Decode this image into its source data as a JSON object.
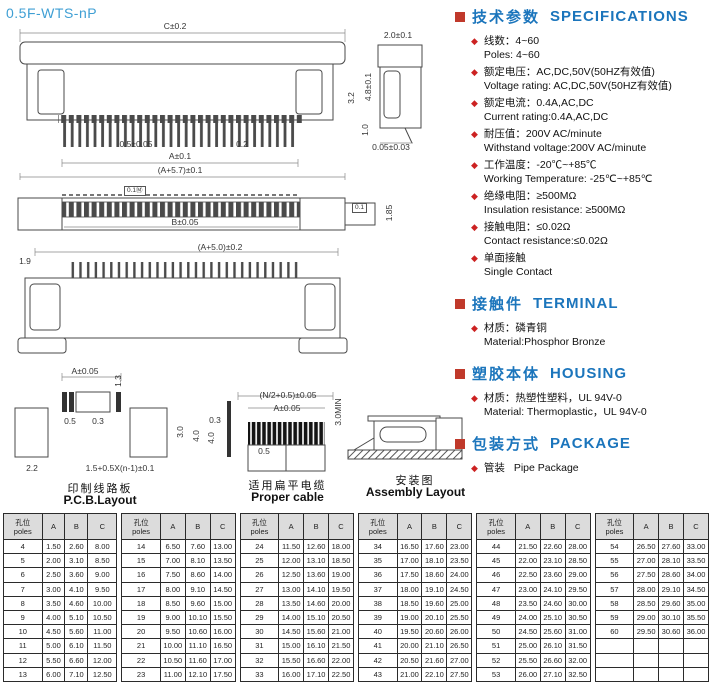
{
  "page": {
    "title": "0.5F-WTS-nP"
  },
  "colors": {
    "accent_blue": "#1b75bc",
    "title_blue": "#3f9fd4",
    "bullet_red": "#c0392b",
    "diamond_red": "#cc2222"
  },
  "specs": {
    "heading_cn": "技术参数",
    "heading_en": "SPECIFICATIONS",
    "items": [
      {
        "cn": "线数：4~60",
        "en": "Poles: 4~60"
      },
      {
        "cn": "额定电压：AC,DC,50V(50HZ有效值)",
        "en": "Voltage rating: AC,DC,50V(50HZ有效值)"
      },
      {
        "cn": "额定电流：0.4A,AC,DC",
        "en": "Current rating:0.4A,AC,DC"
      },
      {
        "cn": "耐压值：200V AC/minute",
        "en": "Withstand voltage:200V AC/minute"
      },
      {
        "cn": "工作温度：-20℃~+85℃",
        "en": "Working Temperature: -25℃~+85℃"
      },
      {
        "cn": "绝缘电阻：≥500MΩ",
        "en": "Insulation resistance: ≥500MΩ"
      },
      {
        "cn": "接触电阻：≤0.02Ω",
        "en": "Contact resistance:≤0.02Ω"
      },
      {
        "cn": "单面接触",
        "en": "Single Contact"
      }
    ]
  },
  "terminal": {
    "heading_cn": "接触件",
    "heading_en": "TERMINAL",
    "item_cn": "材质：磷青铜",
    "item_en": "Material:Phosphor Bronze"
  },
  "housing": {
    "heading_cn": "塑胶本体",
    "heading_en": "HOUSING",
    "item_cn": "材质：热塑性塑料，UL 94V-0",
    "item_en": "Material: Thermoplastic，UL 94V-0"
  },
  "package": {
    "heading_cn": "包装方式",
    "heading_en": "PACKAGE",
    "item_cn": "管装",
    "item_en": "Pipe Package"
  },
  "drawings": {
    "front": {
      "c": "C±0.2",
      "pitch": "0.5±0.05",
      "pin_w": "0.2",
      "a": "A±0.1",
      "total": "(A+5.7)±0.1",
      "h": "3.2"
    },
    "side": {
      "top": "2.0±0.1",
      "h": "4.8±0.1",
      "foot": "1.0",
      "bottom": "0.05±0.03"
    },
    "top_view": {
      "b": "B±0.05",
      "h": "1.85",
      "tol_left": "0.1Ⓜ",
      "tol_right": "0.1"
    },
    "bottom_view": {
      "total": "(A+5.0)±0.2",
      "edge": "1.9"
    },
    "pcb": {
      "a": "A±0.05",
      "d13": "1.3",
      "d05": "0.5",
      "d03": "0.3",
      "d30": "3.0",
      "d40": "4.0",
      "d22": "2.2",
      "formula": "1.5+0.5X(n-1)±0.1",
      "side03": "0.3",
      "side40": "4.0",
      "cap_cn": "印制线路板",
      "cap_en": "P.C.B.Layout"
    },
    "cable": {
      "n": "(N/2+0.5)±0.05",
      "a": "A±0.05",
      "min": "3.0MIN",
      "d05": "0.5",
      "cap_cn": "适用扁平电缆",
      "cap_en": "Proper cable"
    },
    "assembly": {
      "cap_cn": "安装图",
      "cap_en": "Assembly Layout"
    }
  },
  "table": {
    "header": {
      "poles_cn": "孔位",
      "poles_en": "poles",
      "a": "A",
      "b": "B",
      "c": "C"
    },
    "groups": [
      [
        [
          "4",
          "1.50",
          "2.60",
          "8.00"
        ],
        [
          "5",
          "2.00",
          "3.10",
          "8.50"
        ],
        [
          "6",
          "2.50",
          "3.60",
          "9.00"
        ],
        [
          "7",
          "3.00",
          "4.10",
          "9.50"
        ],
        [
          "8",
          "3.50",
          "4.60",
          "10.00"
        ],
        [
          "9",
          "4.00",
          "5.10",
          "10.50"
        ],
        [
          "10",
          "4.50",
          "5.60",
          "11.00"
        ],
        [
          "11",
          "5.00",
          "6.10",
          "11.50"
        ],
        [
          "12",
          "5.50",
          "6.60",
          "12.00"
        ],
        [
          "13",
          "6.00",
          "7.10",
          "12.50"
        ]
      ],
      [
        [
          "14",
          "6.50",
          "7.60",
          "13.00"
        ],
        [
          "15",
          "7.00",
          "8.10",
          "13.50"
        ],
        [
          "16",
          "7.50",
          "8.60",
          "14.00"
        ],
        [
          "17",
          "8.00",
          "9.10",
          "14.50"
        ],
        [
          "18",
          "8.50",
          "9.60",
          "15.00"
        ],
        [
          "19",
          "9.00",
          "10.10",
          "15.50"
        ],
        [
          "20",
          "9.50",
          "10.60",
          "16.00"
        ],
        [
          "21",
          "10.00",
          "11.10",
          "16.50"
        ],
        [
          "22",
          "10.50",
          "11.60",
          "17.00"
        ],
        [
          "23",
          "11.00",
          "12.10",
          "17.50"
        ]
      ],
      [
        [
          "24",
          "11.50",
          "12.60",
          "18.00"
        ],
        [
          "25",
          "12.00",
          "13.10",
          "18.50"
        ],
        [
          "26",
          "12.50",
          "13.60",
          "19.00"
        ],
        [
          "27",
          "13.00",
          "14.10",
          "19.50"
        ],
        [
          "28",
          "13.50",
          "14.60",
          "20.00"
        ],
        [
          "29",
          "14.00",
          "15.10",
          "20.50"
        ],
        [
          "30",
          "14.50",
          "15.60",
          "21.00"
        ],
        [
          "31",
          "15.00",
          "16.10",
          "21.50"
        ],
        [
          "32",
          "15.50",
          "16.60",
          "22.00"
        ],
        [
          "33",
          "16.00",
          "17.10",
          "22.50"
        ]
      ],
      [
        [
          "34",
          "16.50",
          "17.60",
          "23.00"
        ],
        [
          "35",
          "17.00",
          "18.10",
          "23.50"
        ],
        [
          "36",
          "17.50",
          "18.60",
          "24.00"
        ],
        [
          "37",
          "18.00",
          "19.10",
          "24.50"
        ],
        [
          "38",
          "18.50",
          "19.60",
          "25.00"
        ],
        [
          "39",
          "19.00",
          "20.10",
          "25.50"
        ],
        [
          "40",
          "19.50",
          "20.60",
          "26.00"
        ],
        [
          "41",
          "20.00",
          "21.10",
          "26.50"
        ],
        [
          "42",
          "20.50",
          "21.60",
          "27.00"
        ],
        [
          "43",
          "21.00",
          "22.10",
          "27.50"
        ]
      ],
      [
        [
          "44",
          "21.50",
          "22.60",
          "28.00"
        ],
        [
          "45",
          "22.00",
          "23.10",
          "28.50"
        ],
        [
          "46",
          "22.50",
          "23.60",
          "29.00"
        ],
        [
          "47",
          "23.00",
          "24.10",
          "29.50"
        ],
        [
          "48",
          "23.50",
          "24.60",
          "30.00"
        ],
        [
          "49",
          "24.00",
          "25.10",
          "30.50"
        ],
        [
          "50",
          "24.50",
          "25.60",
          "31.00"
        ],
        [
          "51",
          "25.00",
          "26.10",
          "31.50"
        ],
        [
          "52",
          "25.50",
          "26.60",
          "32.00"
        ],
        [
          "53",
          "26.00",
          "27.10",
          "32.50"
        ]
      ],
      [
        [
          "54",
          "26.50",
          "27.60",
          "33.00"
        ],
        [
          "55",
          "27.00",
          "28.10",
          "33.50"
        ],
        [
          "56",
          "27.50",
          "28.60",
          "34.00"
        ],
        [
          "57",
          "28.00",
          "29.10",
          "34.50"
        ],
        [
          "58",
          "28.50",
          "29.60",
          "35.00"
        ],
        [
          "59",
          "29.00",
          "30.10",
          "35.50"
        ],
        [
          "60",
          "29.50",
          "30.60",
          "36.00"
        ],
        [
          "",
          "",
          "",
          ""
        ],
        [
          "",
          "",
          "",
          ""
        ],
        [
          "",
          "",
          "",
          ""
        ]
      ]
    ]
  }
}
